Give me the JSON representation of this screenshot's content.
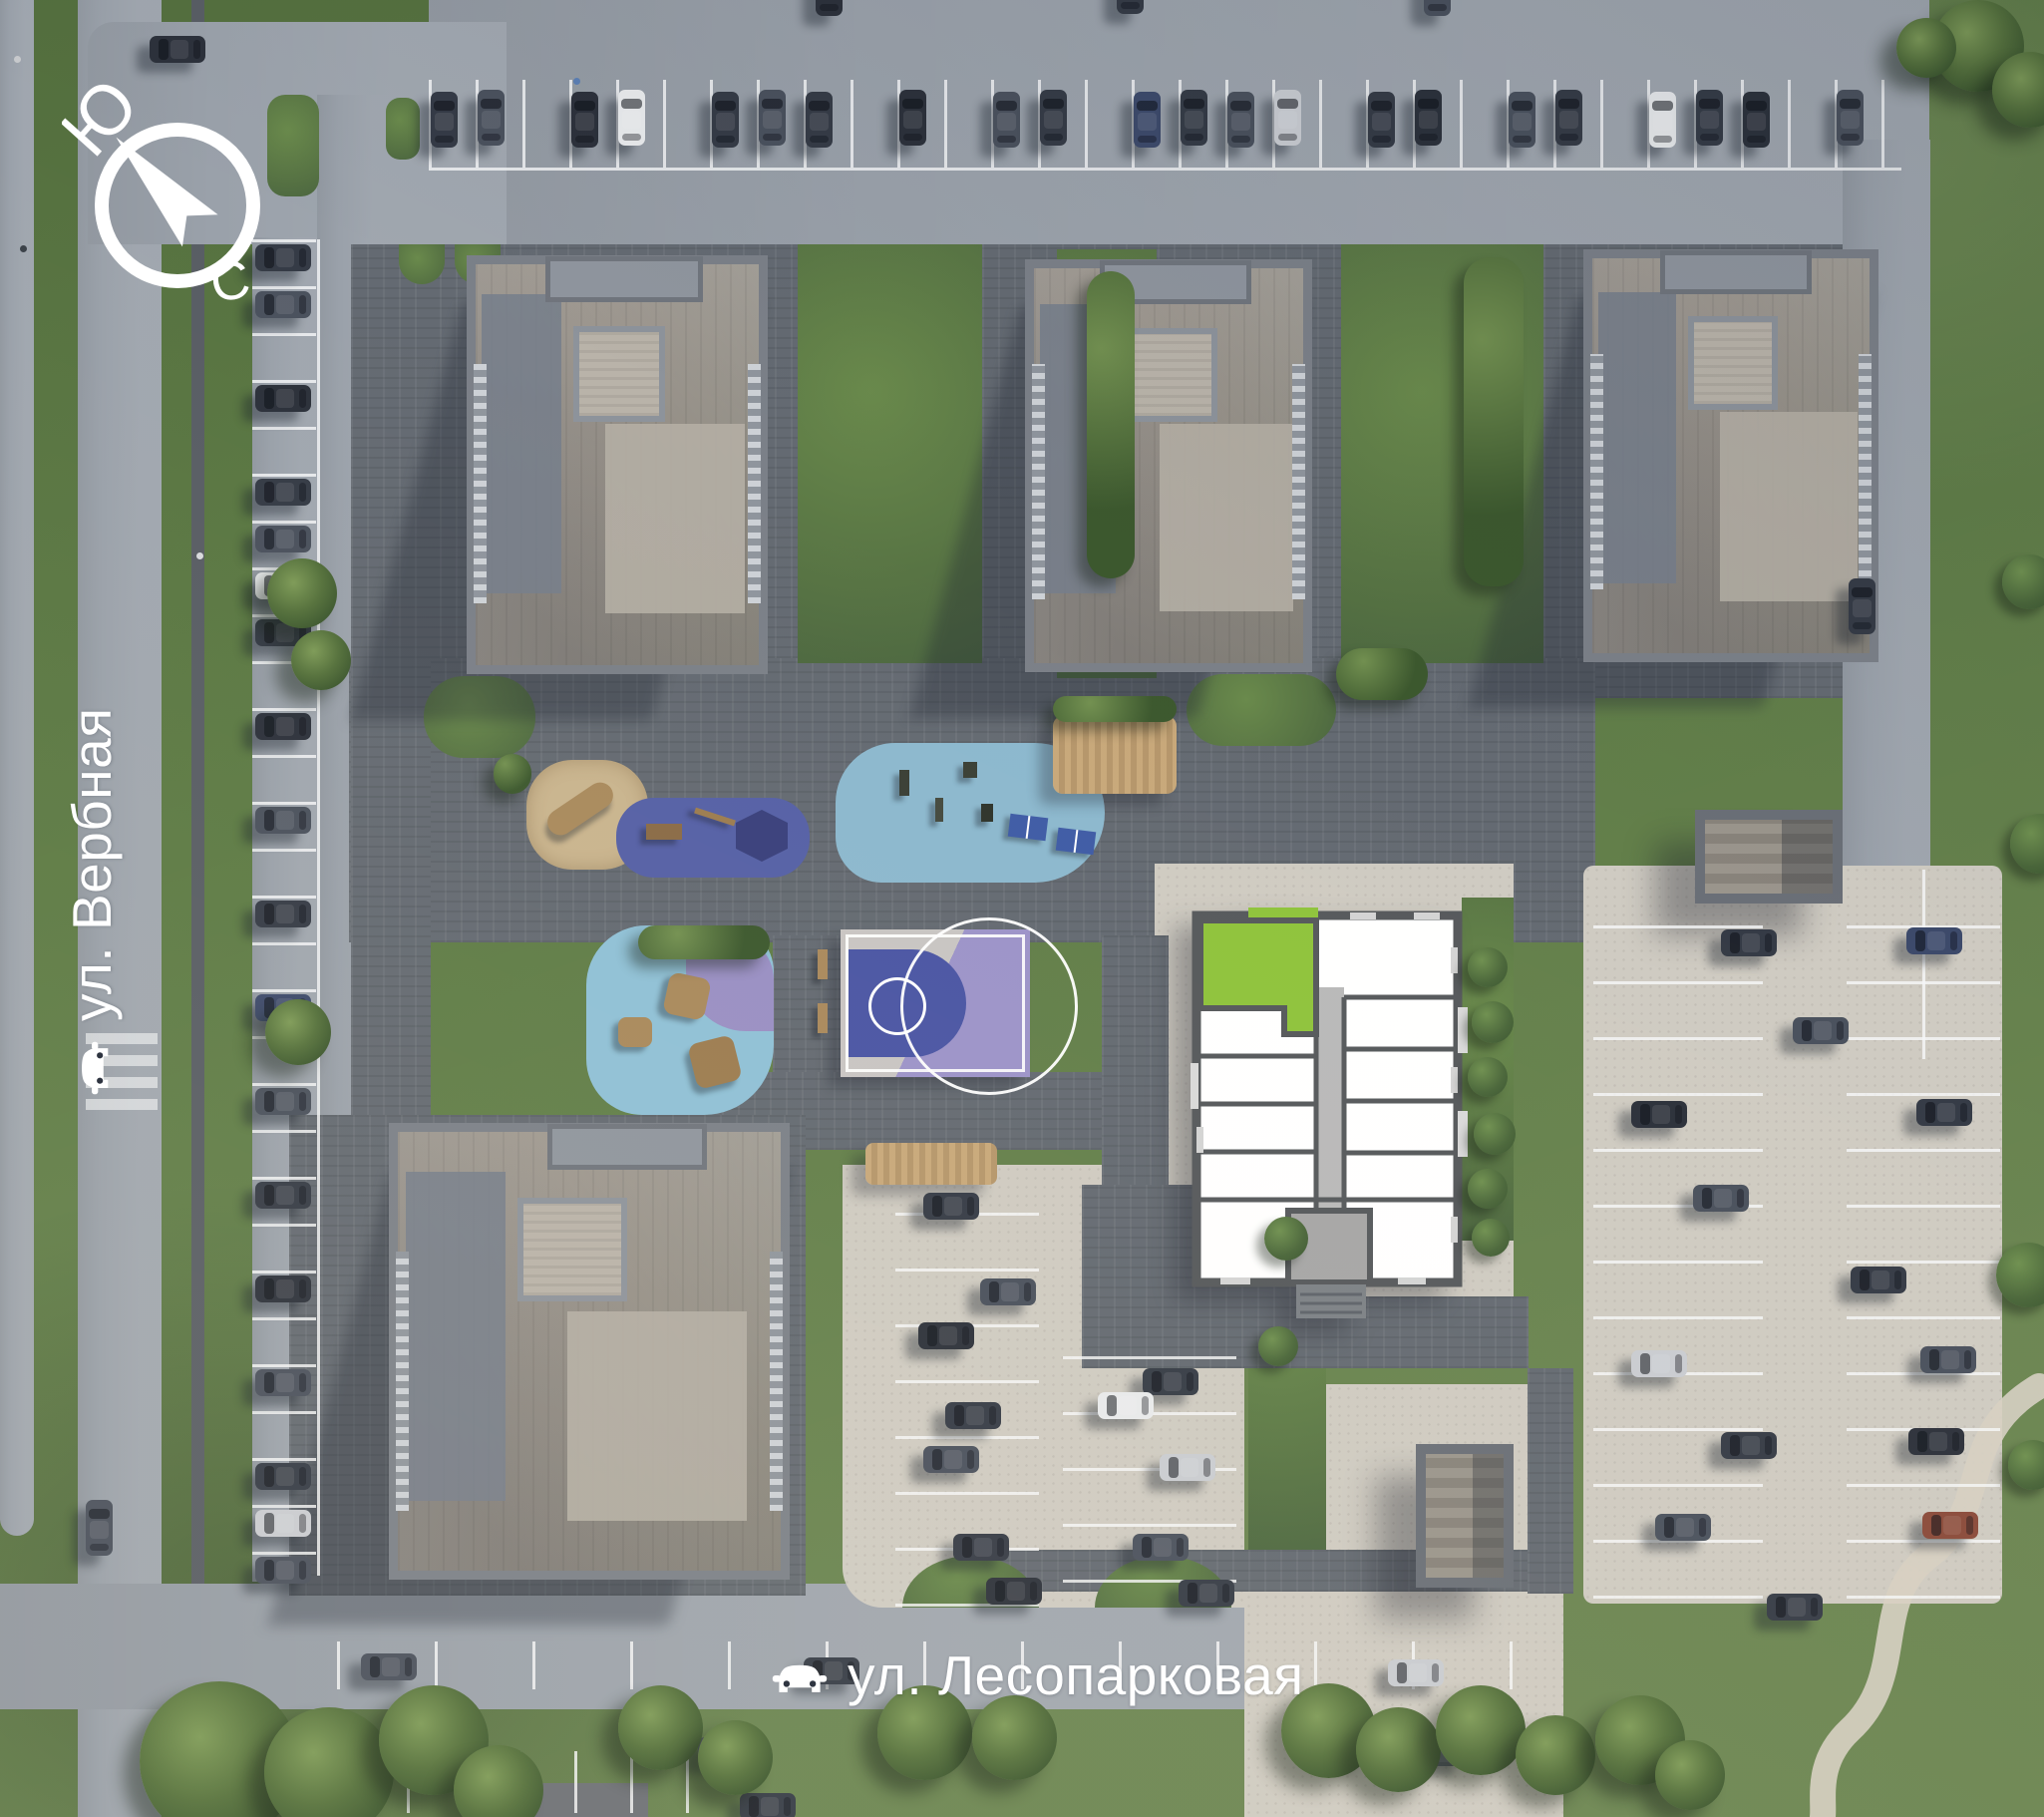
{
  "site_plan": {
    "compass": {
      "icon": "compass-icon",
      "south_label": "Ю",
      "north_label": "С"
    },
    "streets": {
      "verbnaya": {
        "label": "ул. Вербная",
        "icon": "car-icon",
        "orientation": "vertical"
      },
      "lesoparkovaya": {
        "label": "ул. Лесопарковая",
        "icon": "car-icon",
        "orientation": "horizontal"
      }
    },
    "selected_building": {
      "display": "floor-plan-overlay",
      "highlighted_apartment_color": "#8FC33C"
    },
    "palette": {
      "apartment_highlight": "#8FC33C",
      "playground_dark_blue": "#5560A6",
      "playground_light_blue": "#8CB8CE",
      "playground_purple": "#998FC4",
      "basketball_court_blue": "#4A55A4",
      "grass": "#5C7A44",
      "asphalt": "#9AA1AA",
      "concrete": "#CFCBC2",
      "paver_dark": "#646A72"
    }
  }
}
